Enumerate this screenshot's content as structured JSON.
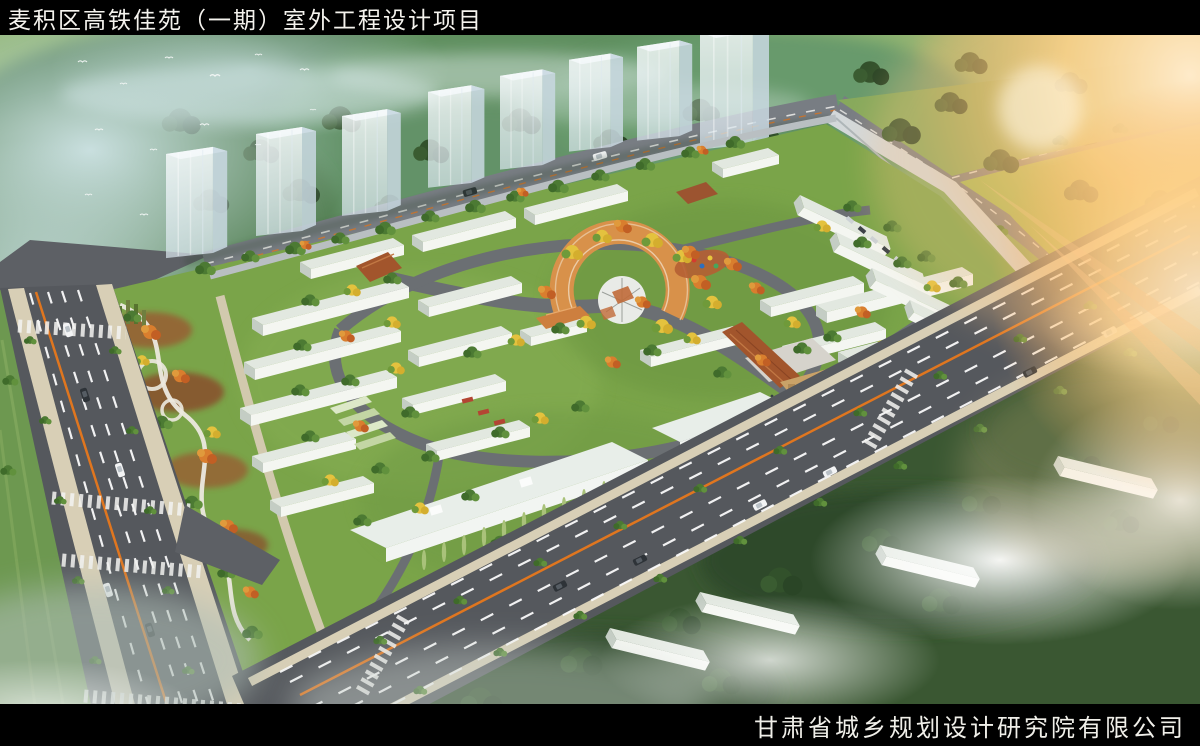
{
  "header": {
    "title": "麦积区高铁佳苑（一期）室外工程设计项目"
  },
  "footer": {
    "company": "甘肃省城乡规划设计研究院有限公司"
  },
  "palette": {
    "bar_background": "#000000",
    "bar_text": "#f5f3ee",
    "asphalt": "#55585d",
    "lane_marking": "#fafafa",
    "center_line_orange": "#e0761f",
    "site_green": "#7aa449",
    "hill_green": "#5d8a62",
    "autumn_yellow": "#e4c23e",
    "autumn_orange": "#d97e2e",
    "tree_green": "#4c7a33",
    "plaza_terracotta": "#d8914a",
    "building_roof": "#e2e8e0",
    "building_wall": "#f4f6f1",
    "tower_glass": "#e3edf3",
    "entrance_canopy": "#a2552c",
    "pool_teal": "#3fb3a6",
    "sun_glare": "#ffd98f",
    "fog_white": "#ffffff"
  }
}
